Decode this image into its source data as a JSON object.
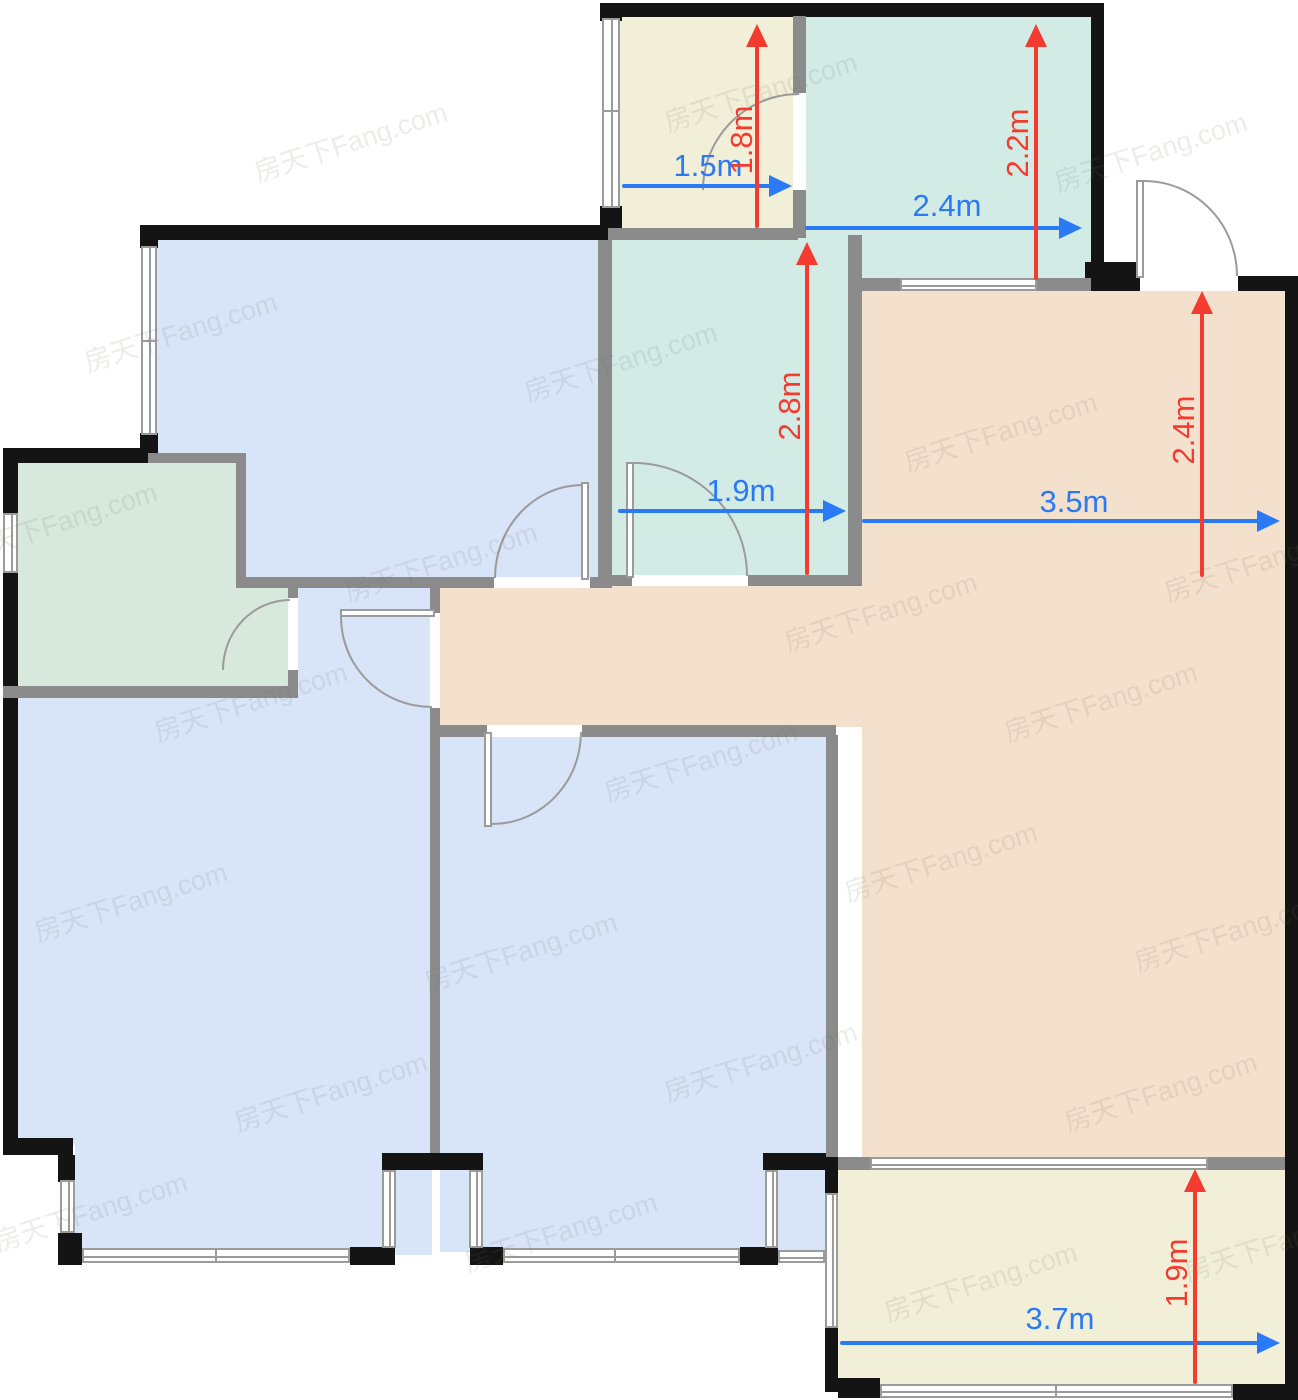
{
  "watermark": {
    "text": "房天下Fang.com",
    "positions": [
      [
        350,
        140
      ],
      [
        760,
        90
      ],
      [
        1150,
        150
      ],
      [
        180,
        330
      ],
      [
        620,
        360
      ],
      [
        1000,
        430
      ],
      [
        60,
        520
      ],
      [
        440,
        560
      ],
      [
        880,
        610
      ],
      [
        1260,
        560
      ],
      [
        250,
        700
      ],
      [
        700,
        760
      ],
      [
        1100,
        700
      ],
      [
        130,
        900
      ],
      [
        520,
        950
      ],
      [
        940,
        860
      ],
      [
        1230,
        930
      ],
      [
        330,
        1090
      ],
      [
        760,
        1060
      ],
      [
        1160,
        1090
      ],
      [
        90,
        1210
      ],
      [
        560,
        1230
      ],
      [
        980,
        1280
      ],
      [
        1280,
        1240
      ]
    ]
  },
  "colors": {
    "room-blue": "#d8e4f8",
    "room-teal": "#d2ebe4",
    "room-green": "#d6e9dc",
    "room-cream": "#f1efd7",
    "room-peach": "#f3e1cd",
    "wall-black": "#141414",
    "wall-gray": "#8b8b8b",
    "line-gray": "#9b9b9b",
    "dim-blue": "#2b7af5",
    "dim-red": "#f43b30",
    "wm-color": "rgba(110,105,95,0.13)"
  },
  "dims": {
    "w_closet": "1.5m",
    "h_closet": "1.8m",
    "w_bath_top": "2.4m",
    "h_bath_top": "2.2m",
    "w_bath_mid": "1.9m",
    "h_bath_mid": "2.8m",
    "w_living": "3.5m",
    "h_living": "2.4m",
    "w_balcony": "3.7m",
    "h_balcony": "1.9m"
  }
}
